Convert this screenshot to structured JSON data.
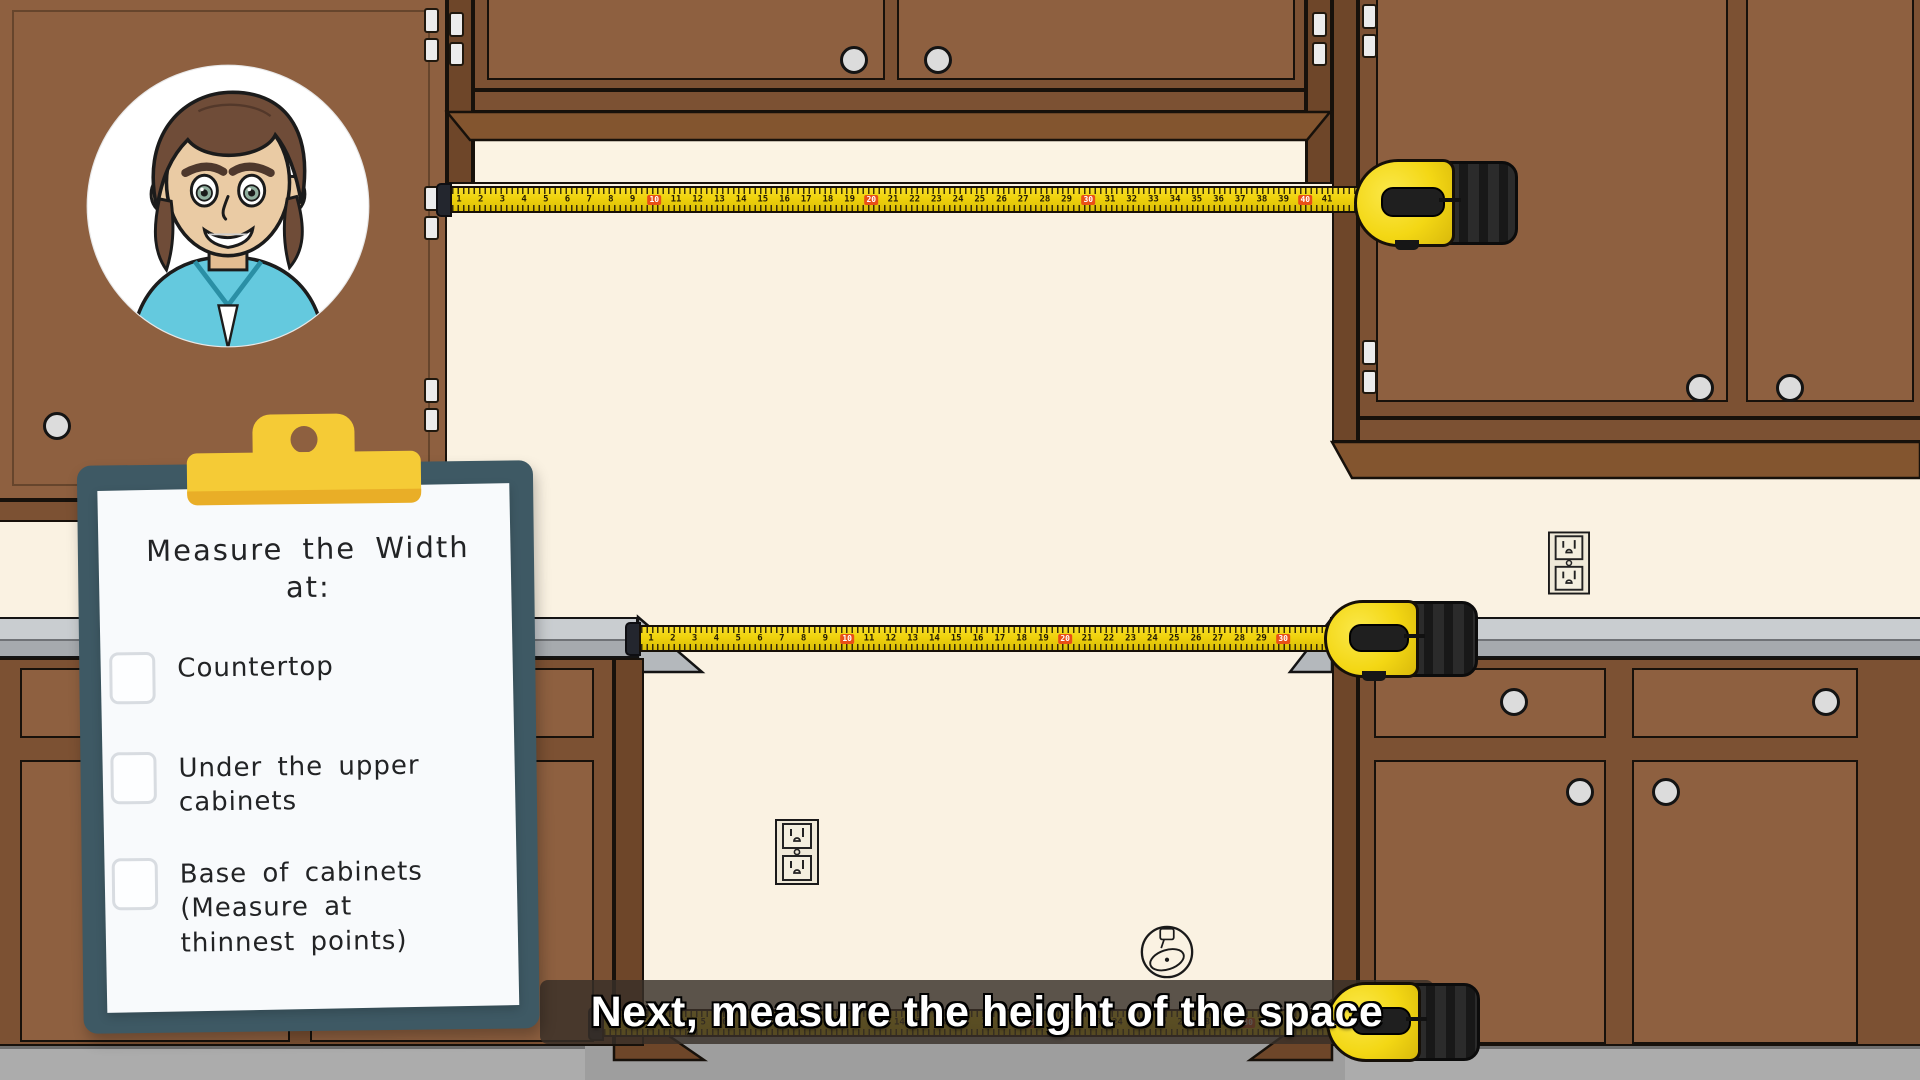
{
  "clipboard": {
    "title_line1": "Measure the Width",
    "title_line2": "at:",
    "items": [
      {
        "label": "Countertop",
        "checked": false
      },
      {
        "label": "Under the upper cabinets",
        "checked": false
      },
      {
        "label": "Base of cabinets (Measure at thinnest points)",
        "checked": false
      }
    ]
  },
  "caption": {
    "text": "Next, measure the height of the space"
  },
  "tapes": {
    "top": {
      "first": 1,
      "last": 41,
      "highlight_every": 10
    },
    "countertop": {
      "first": 1,
      "last": 30,
      "highlight_every": 10
    },
    "bottom": {
      "first": 1,
      "last": 33,
      "highlight_every": 10
    }
  },
  "icons": {
    "avatar": "presenter-avatar",
    "outlet": "power-outlet",
    "watermark": "tape-measure-logo",
    "tape": "tape-measure"
  },
  "colors": {
    "wall": "#FAF2E2",
    "cabinet_door": "#8E6040",
    "cabinet_frame": "#7C5133",
    "cabinet_side": "#6E4629",
    "countertop": "#C9CDD0",
    "floor": "#ACACAC",
    "tape_yellow": "#F2D60F",
    "tape_red": "#E94F16",
    "clipboard_board": "#3E5964",
    "clip_yellow": "#F5CB36",
    "caption_bg": "rgba(56,48,40,0.82)",
    "shirt_teal": "#64C9DE"
  }
}
